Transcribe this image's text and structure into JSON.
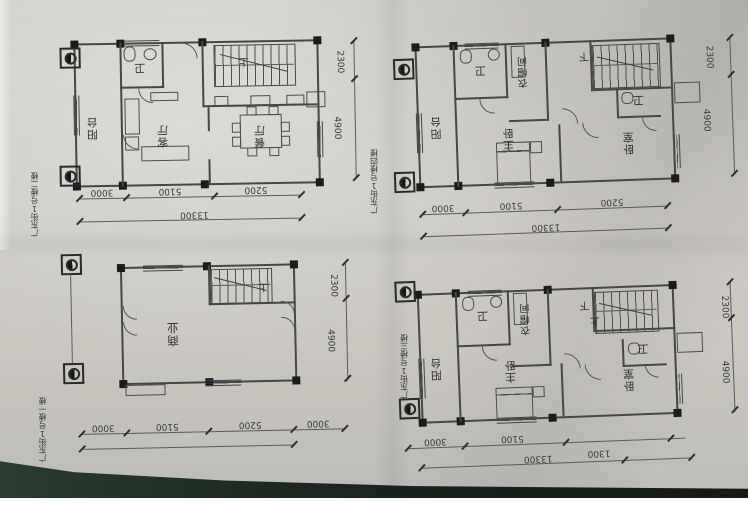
{
  "plans": {
    "floor2": {
      "axis_label": "广东街1号楼二楼",
      "rooms": {
        "balcony": "阳台",
        "living": "客厅",
        "dining": "餐厅",
        "bath": "卫"
      },
      "stairs": {
        "up": "上"
      },
      "dims_bottom": [
        "3000",
        "5100",
        "5200"
      ],
      "dim_total": "13300",
      "dims_right": [
        "2300",
        "4900"
      ]
    },
    "floor4": {
      "axis_label": "广东街1号楼四楼",
      "rooms": {
        "balcony": "阳台",
        "bath1": "卫",
        "cloakroom": "衣帽间",
        "master": "主卧",
        "bedroom": "卧室",
        "bath2": "卫"
      },
      "stairs": {
        "down": "下"
      },
      "dims_bottom": [
        "3000",
        "5100",
        "5200"
      ],
      "dim_total": "13300",
      "dims_right": [
        "2300",
        "4900"
      ]
    },
    "floor1": {
      "axis_label": "广东街1号楼一楼",
      "rooms": {
        "commercial": "商业"
      },
      "stairs": {
        "up": "上"
      },
      "dims_bottom": [
        "3000",
        "5100",
        "5200",
        "3000"
      ],
      "dims_right": [
        "2300",
        "4900"
      ]
    },
    "floor3": {
      "axis_label": "广东街1号楼三楼",
      "rooms": {
        "balcony": "阳台",
        "bath1": "卫",
        "cloakroom": "衣帽间",
        "master": "主卧",
        "bedroom": "卧室",
        "bath2": "卫"
      },
      "stairs": {
        "up": "上",
        "down": "下"
      },
      "dims_bottom": [
        "3000",
        "5100"
      ],
      "dim_total": "13300",
      "dim_extra": "1300",
      "dims_right": [
        "2300",
        "4900"
      ]
    }
  }
}
